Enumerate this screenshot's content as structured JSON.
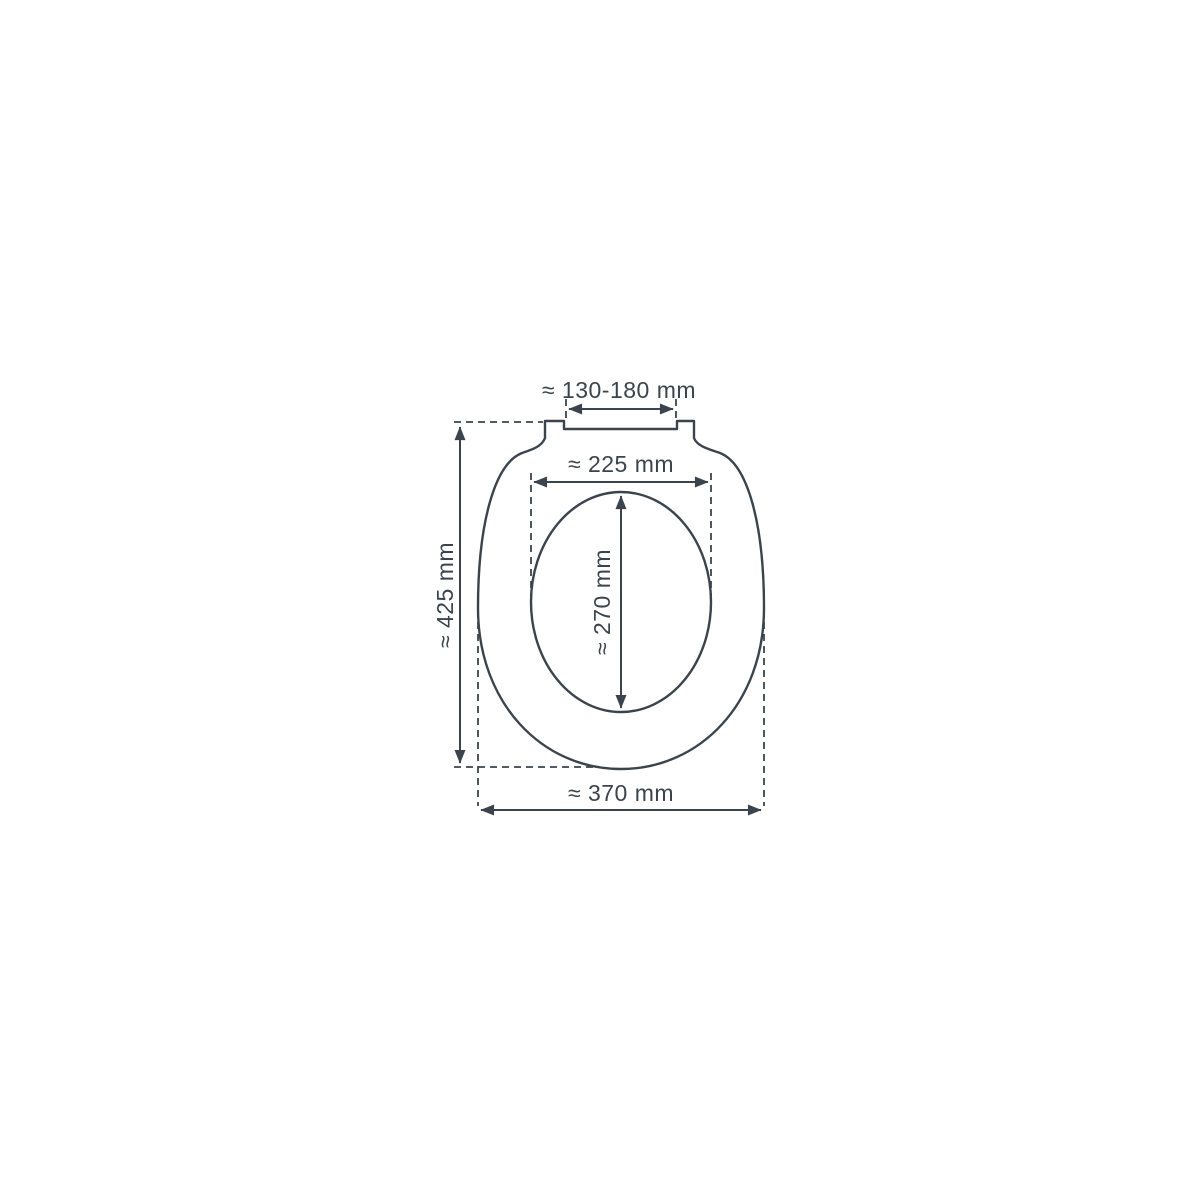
{
  "diagram": {
    "subject": "toilet-seat-top-view-dimension-drawing",
    "unit": "mm",
    "colors": {
      "background": "#ffffff",
      "line": "#3b444c"
    },
    "labels": {
      "hinge_spacing": "≈ 130-180 mm",
      "inner_width": "≈ 225 mm",
      "inner_length": "≈ 270 mm",
      "overall_length": "≈ 425 mm",
      "overall_width": "≈ 370 mm"
    }
  }
}
